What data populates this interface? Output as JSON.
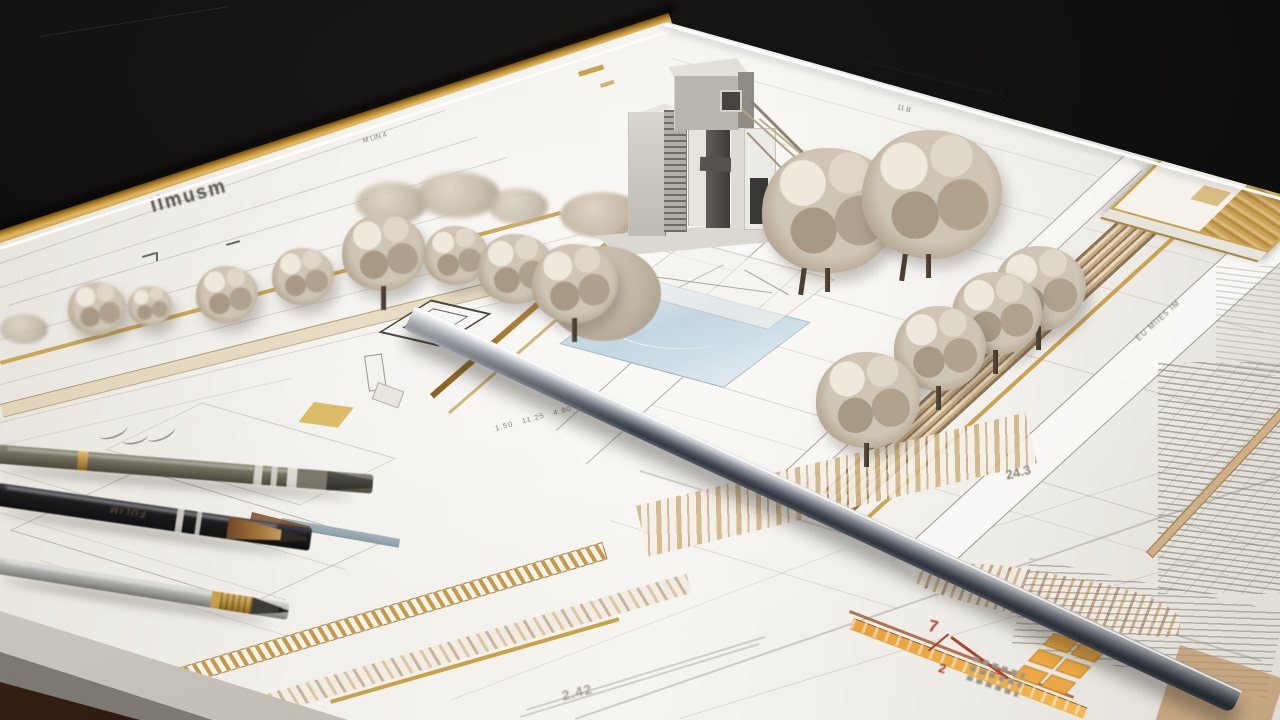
{
  "annotations": {
    "plan_label_left": "Ilmusm",
    "note_top_left": "M LIN 4",
    "note_top_center": "11 B",
    "dimension_row": "1.50   11.25   4.80",
    "road_label_right": "EU MIIE5 IM",
    "spot_elevation_right": "24.3",
    "spot_elevation_bottom": "2.42",
    "red_mark_primary": "7",
    "red_mark_secondary": "2"
  },
  "colors": {
    "desk_black": "#0c0b0a",
    "paper_white": "#f2f0eb",
    "binding_gold": "#c99c44",
    "road_tan": "#c4a070",
    "foliage_taupe": "#c7bcab",
    "trunk_brown": "#4e4336",
    "ruler_steel_light": "#d4d6d9",
    "ruler_steel_dark": "#3a3f48",
    "pool_blue": "#c2d6e2",
    "accent_orange": "#e9a13c",
    "accent_red": "#b43c2a",
    "pen_olive": "#6f6b5c",
    "pen_black": "#1d1d20",
    "pen_silver": "#a8a8a4"
  }
}
